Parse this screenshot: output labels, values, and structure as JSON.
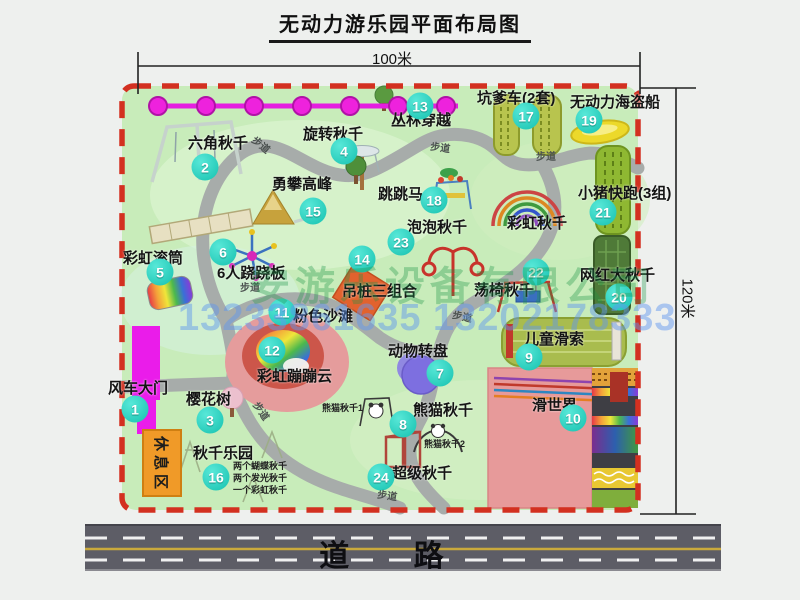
{
  "title": "无动力游乐园平面布局图",
  "dimensions": {
    "width": "100米",
    "height": "120米"
  },
  "road": {
    "label": "道 路"
  },
  "rest_area": {
    "label": "休息区"
  },
  "walkway_label": "步道",
  "watermarks": {
    "company": "安游乐设备有限公司",
    "phone": "13233861635 13202178333"
  },
  "colors": {
    "park_green": "#c8ecba",
    "border_dash_red": "#d33020",
    "badge_teal": "#16c1af",
    "gate_magenta": "#ea1cea",
    "zipline_magenta": "#e51ee0",
    "rest_area_orange": "#f09a28",
    "road_gray": "#5d5d66"
  },
  "attractions": [
    {
      "num": "1",
      "name": "风车大门",
      "label": {
        "x": 108,
        "y": 381
      },
      "badge": {
        "x": 135,
        "y": 409
      }
    },
    {
      "num": "2",
      "name": "六角秋千",
      "label": {
        "x": 188,
        "y": 136
      },
      "badge": {
        "x": 205,
        "y": 167
      }
    },
    {
      "num": "3",
      "name": "樱花树",
      "label": {
        "x": 186,
        "y": 392
      },
      "badge": {
        "x": 210,
        "y": 420
      }
    },
    {
      "num": "4",
      "name": "旋转秋千",
      "label": {
        "x": 303,
        "y": 127
      },
      "badge": {
        "x": 344,
        "y": 151
      }
    },
    {
      "num": "5",
      "name": "彩虹滚筒",
      "label": {
        "x": 123,
        "y": 251
      },
      "badge": {
        "x": 160,
        "y": 272
      }
    },
    {
      "num": "6",
      "name": "6人跷跷板",
      "label": {
        "x": 217,
        "y": 266
      },
      "badge": {
        "x": 223,
        "y": 252
      }
    },
    {
      "num": "7",
      "name": "动物转盘",
      "label": {
        "x": 388,
        "y": 344
      },
      "badge": {
        "x": 440,
        "y": 373
      }
    },
    {
      "num": "8",
      "name": "熊猫秋千",
      "label": {
        "x": 413,
        "y": 403
      },
      "badge": {
        "x": 403,
        "y": 424
      }
    },
    {
      "num": "9",
      "name": "儿童滑索",
      "label": {
        "x": 524,
        "y": 332
      },
      "badge": {
        "x": 529,
        "y": 357
      }
    },
    {
      "num": "10",
      "name": "滑世界",
      "label": {
        "x": 532,
        "y": 398
      },
      "badge": {
        "x": 573,
        "y": 418
      }
    },
    {
      "num": "11",
      "name": "粉色沙滩",
      "label": {
        "x": 293,
        "y": 309
      },
      "badge": {
        "x": 282,
        "y": 312
      }
    },
    {
      "num": "12",
      "name": "彩虹蹦蹦云",
      "label": {
        "x": 257,
        "y": 369
      },
      "badge": {
        "x": 272,
        "y": 350
      }
    },
    {
      "num": "13",
      "name": "丛林穿越",
      "label": {
        "x": 391,
        "y": 113
      },
      "badge": {
        "x": 420,
        "y": 106
      }
    },
    {
      "num": "14",
      "name": "吊桩三组合",
      "label": {
        "x": 342,
        "y": 284
      },
      "badge": {
        "x": 362,
        "y": 259
      }
    },
    {
      "num": "15",
      "name": "勇攀高峰",
      "label": {
        "x": 272,
        "y": 177
      },
      "badge": {
        "x": 313,
        "y": 211
      }
    },
    {
      "num": "16",
      "name": "秋千乐园",
      "label": {
        "x": 193,
        "y": 446
      },
      "badge": {
        "x": 216,
        "y": 477
      }
    },
    {
      "num": "17",
      "name": "坑爹车(2套)",
      "label": {
        "x": 477,
        "y": 91
      },
      "badge": {
        "x": 526,
        "y": 116
      }
    },
    {
      "num": "18",
      "name": "跳跳马",
      "label": {
        "x": 378,
        "y": 187
      },
      "badge": {
        "x": 434,
        "y": 200
      }
    },
    {
      "num": "19",
      "name": "无动力海盗船",
      "label": {
        "x": 570,
        "y": 95
      },
      "badge": {
        "x": 589,
        "y": 120
      }
    },
    {
      "num": "20",
      "name": "网红大秋千",
      "label": {
        "x": 580,
        "y": 268
      },
      "badge": {
        "x": 619,
        "y": 297
      }
    },
    {
      "num": "21",
      "name": "小猪快跑(3组)",
      "label": {
        "x": 578,
        "y": 186
      },
      "badge": {
        "x": 603,
        "y": 212
      }
    },
    {
      "num": "22",
      "name": "荡椅秋千",
      "label": {
        "x": 474,
        "y": 283
      },
      "badge": {
        "x": 536,
        "y": 272
      }
    },
    {
      "num": "23",
      "name": "泡泡秋千",
      "label": {
        "x": 407,
        "y": 220
      },
      "badge": {
        "x": 401,
        "y": 242
      }
    },
    {
      "num": "24",
      "name": "超级秋千",
      "label": {
        "x": 392,
        "y": 466
      },
      "badge": {
        "x": 381,
        "y": 477
      }
    }
  ],
  "extra_labels": [
    {
      "text": "彩虹秋千",
      "x": 507,
      "y": 216,
      "size": 15
    },
    {
      "text": "熊猫秋千1",
      "x": 322,
      "y": 404,
      "size": 9
    },
    {
      "text": "熊猫秋千2",
      "x": 424,
      "y": 440,
      "size": 9
    },
    {
      "text": "两个蝴蝶秋千",
      "x": 233,
      "y": 462,
      "size": 9
    },
    {
      "text": "两个发光秋千",
      "x": 233,
      "y": 474,
      "size": 9
    },
    {
      "text": "一个彩虹秋千",
      "x": 233,
      "y": 486,
      "size": 9
    }
  ],
  "walkway_labels": [
    {
      "x": 250,
      "y": 141,
      "rot": 40
    },
    {
      "x": 430,
      "y": 144,
      "rot": 8
    },
    {
      "x": 536,
      "y": 153,
      "rot": 0
    },
    {
      "x": 240,
      "y": 284,
      "rot": 0
    },
    {
      "x": 250,
      "y": 407,
      "rot": 55
    },
    {
      "x": 452,
      "y": 313,
      "rot": 12
    },
    {
      "x": 377,
      "y": 492,
      "rot": 8
    }
  ]
}
